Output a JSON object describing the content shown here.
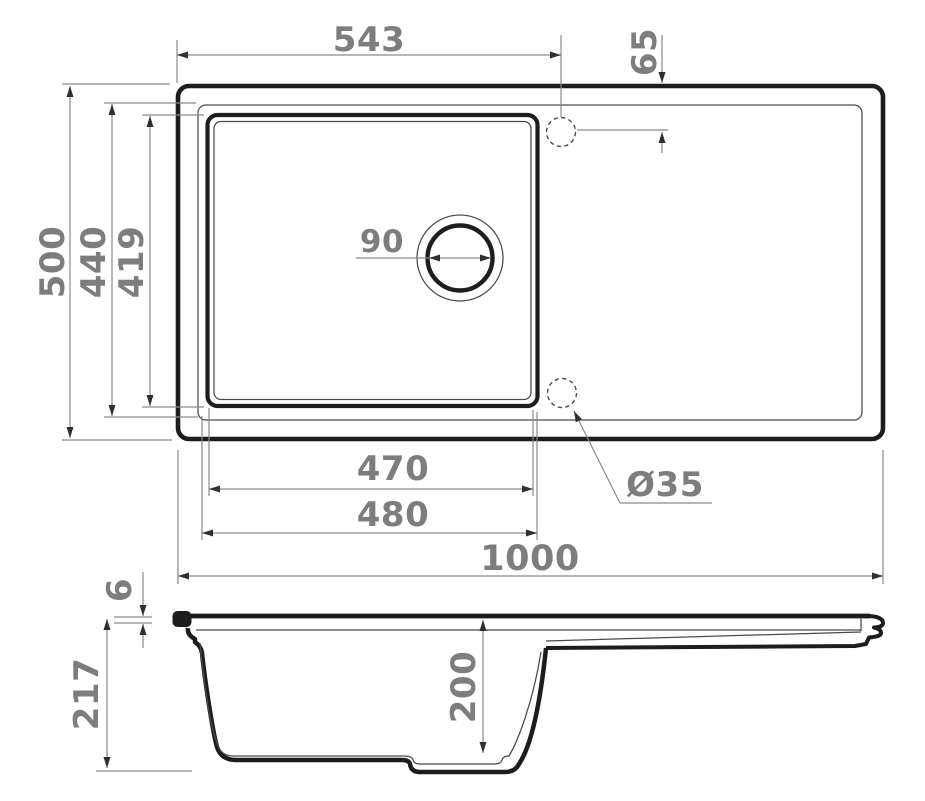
{
  "page": {
    "title": "Kitchen sink installation drawing (top view and section view)"
  },
  "colors": {
    "outline": "#1d1d1b",
    "thin_line": "#4a4a4a",
    "dimension_line": "#8a8a8a",
    "dimension_text": "#7d7d7d",
    "background": "#ffffff"
  },
  "labels": {
    "drain_offset_x": "543",
    "faucet_offset_y": "65",
    "overall_depth": "500",
    "bowl_outer_depth": "440",
    "bowl_inner_depth": "419",
    "drain_diameter": "90",
    "faucet_hole_diameter": "Ø35",
    "bowl_inner_length": "470",
    "bowl_outer_length": "480",
    "overall_length": "1000",
    "rim_thickness": "6",
    "overall_height": "217",
    "bowl_depth": "200"
  }
}
